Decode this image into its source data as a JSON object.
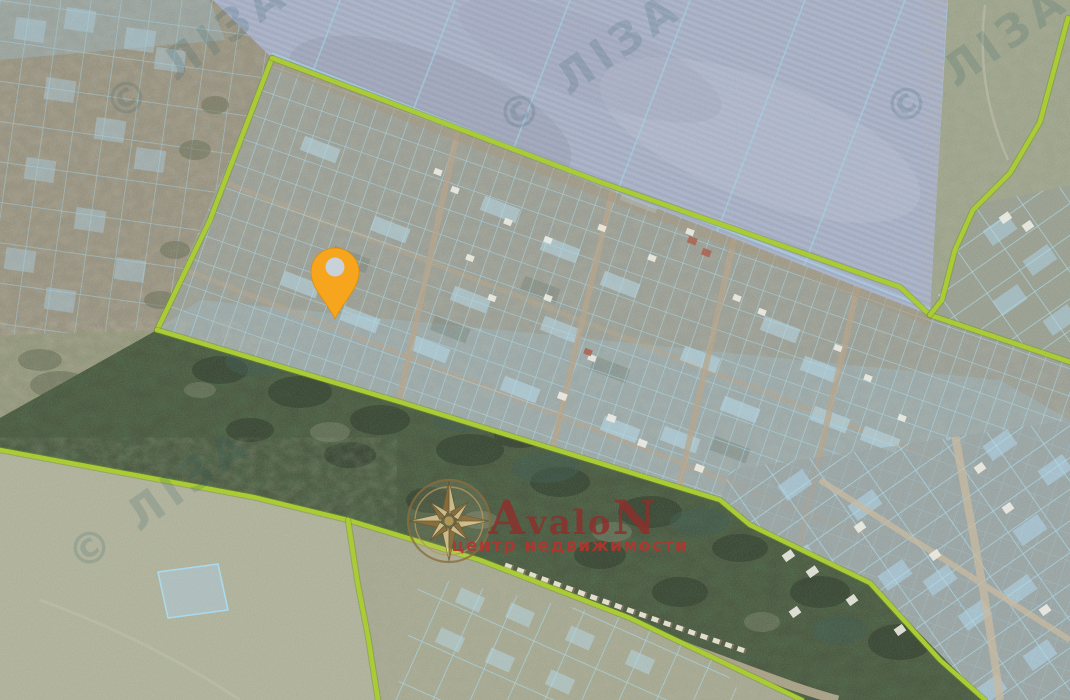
{
  "app": {
    "type": "satellite-cadastral-map",
    "width": 1070,
    "height": 700
  },
  "branding": {
    "logo_title_first": "A",
    "logo_title_middle": "valo",
    "logo_title_last": "N",
    "logo_subtitle": "центр недвижимости",
    "title_color": "#8e2f2b",
    "subtitle_color": "#b5352e",
    "compass_gold": "#c7a45c"
  },
  "tile_watermark": {
    "text": "© ЛІЗА",
    "color": "#2a5a66",
    "opacity": 0.17,
    "instances": [
      {
        "x": 205,
        "y": 62,
        "rot": -35
      },
      {
        "x": 598,
        "y": 76,
        "rot": -35
      },
      {
        "x": 985,
        "y": 68,
        "rot": -35
      },
      {
        "x": 168,
        "y": 512,
        "rot": -35
      }
    ]
  },
  "marker": {
    "name": "selected-location-pin",
    "x": 335,
    "y": 319,
    "color": "#f6a51c",
    "hole_color": "#c9d1d9"
  },
  "boundaries": {
    "color": "#a6c92f",
    "edge_color": "#6f8c1d",
    "width": 4.5,
    "lines": [
      {
        "id": "survey-west",
        "points": [
          [
            272,
            58
          ],
          [
            210,
            220
          ],
          [
            157,
            330
          ]
        ]
      },
      {
        "id": "survey-north",
        "points": [
          [
            272,
            58
          ],
          [
            600,
            182
          ],
          [
            900,
            287
          ],
          [
            930,
            315
          ]
        ]
      },
      {
        "id": "survey-south",
        "points": [
          [
            157,
            330
          ],
          [
            400,
            402
          ],
          [
            720,
            500
          ],
          [
            750,
            525
          ],
          [
            870,
            583
          ],
          [
            940,
            660
          ],
          [
            985,
            700
          ]
        ]
      },
      {
        "id": "survey-east-spur",
        "points": [
          [
            930,
            315
          ],
          [
            1070,
            362
          ]
        ]
      },
      {
        "id": "northeast-boundary",
        "points": [
          [
            1068,
            18
          ],
          [
            1040,
            122
          ],
          [
            1010,
            173
          ],
          [
            973,
            210
          ],
          [
            955,
            250
          ],
          [
            942,
            300
          ],
          [
            930,
            315
          ]
        ]
      },
      {
        "id": "south-field-boundary",
        "points": [
          [
            0,
            450
          ],
          [
            253,
            497
          ],
          [
            348,
            520
          ],
          [
            480,
            560
          ],
          [
            630,
            618
          ],
          [
            760,
            680
          ],
          [
            802,
            700
          ]
        ]
      },
      {
        "id": "south-branch",
        "points": [
          [
            348,
            520
          ],
          [
            358,
            585
          ],
          [
            368,
            636
          ],
          [
            378,
            700
          ]
        ]
      }
    ]
  },
  "overlay_colors": {
    "parcel_line": "#a5d8ec",
    "parcel_fill": "#b7dcef",
    "road": "#b3a289"
  }
}
